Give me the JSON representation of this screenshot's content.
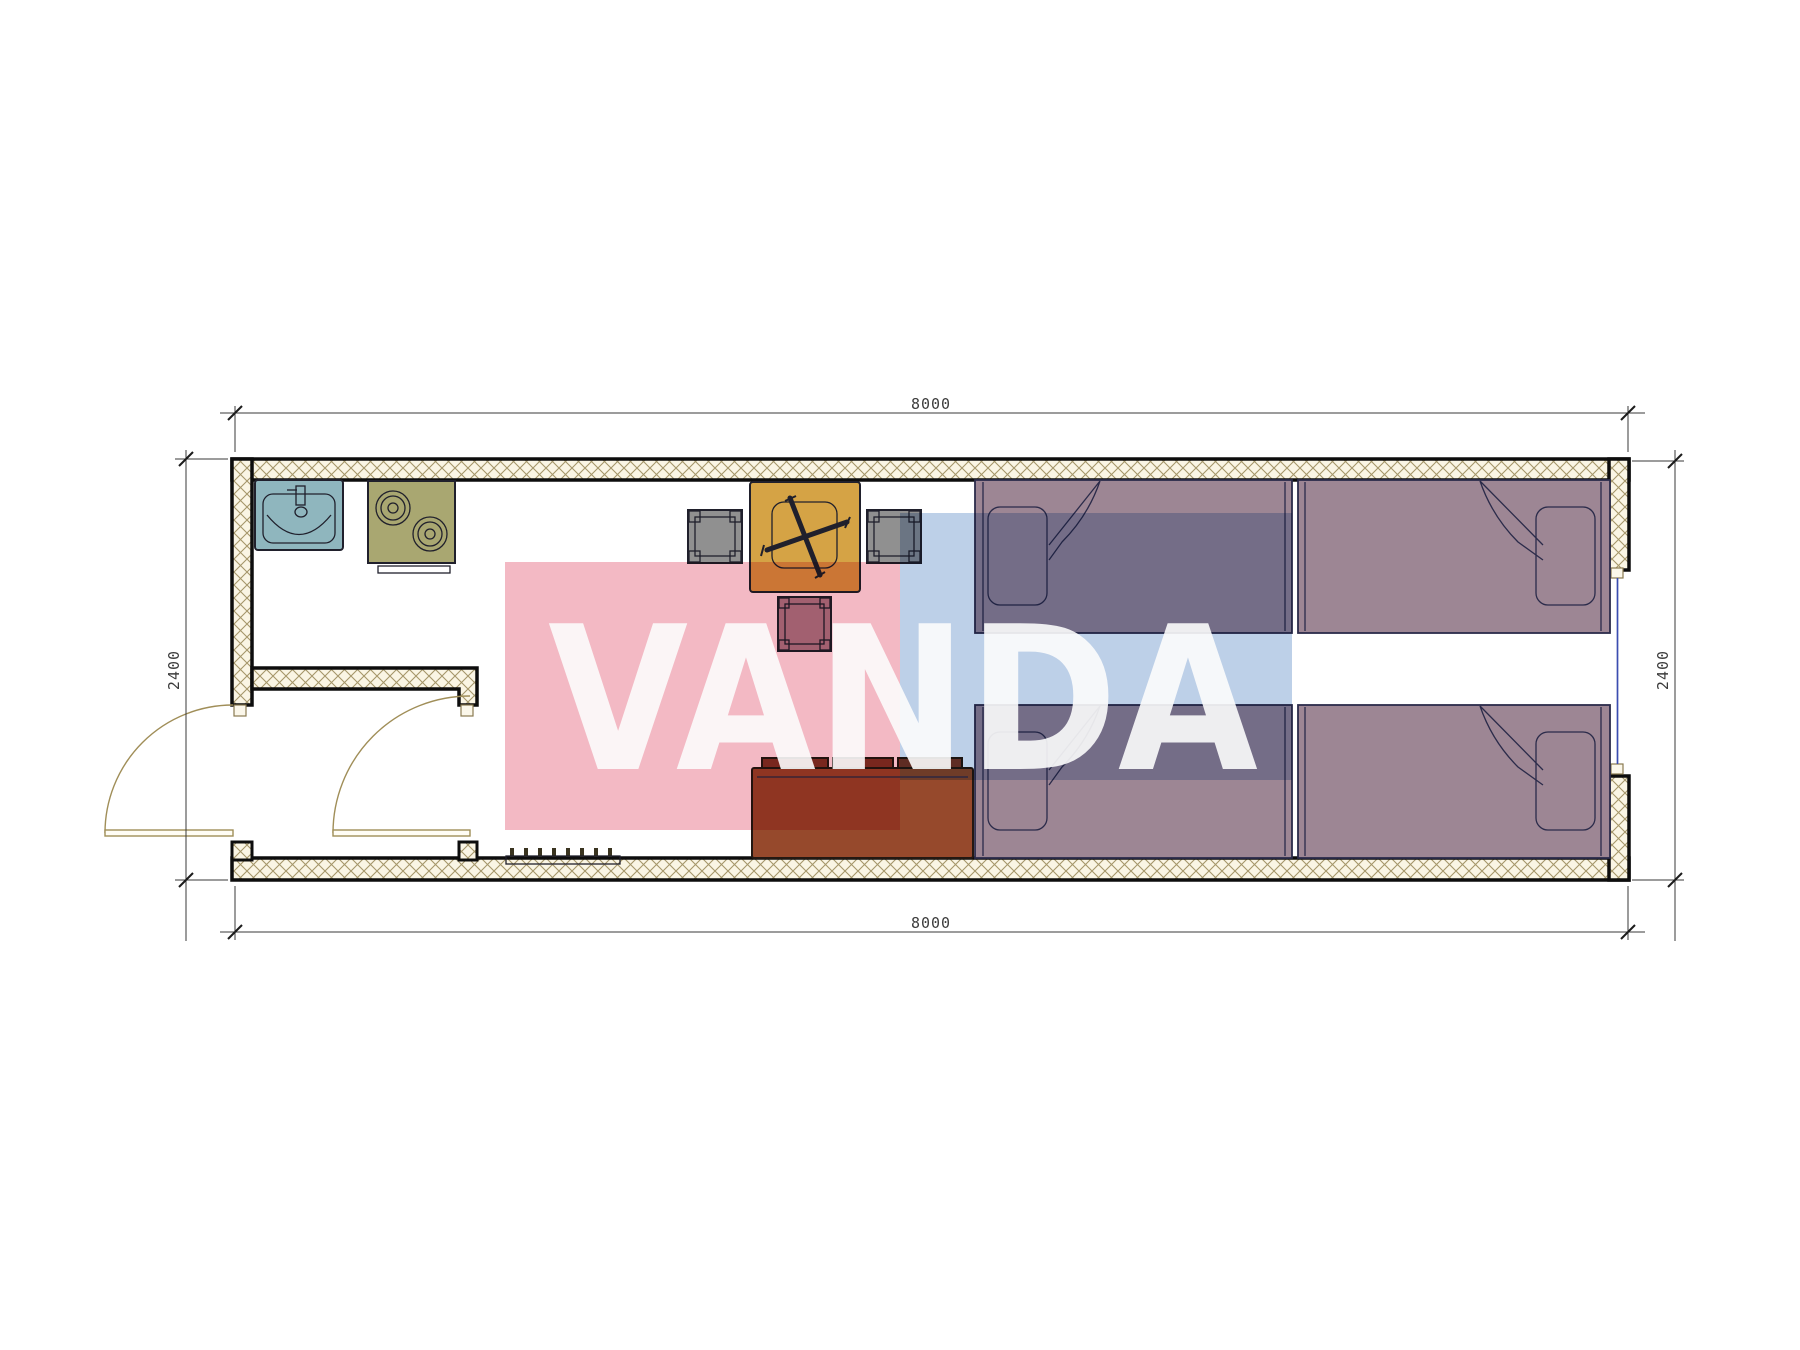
{
  "watermark": {
    "text": "VANDA",
    "pink_color": "#f3b9c4",
    "blue_color": "#bdd0e8",
    "letter_color": "#fcfcfc"
  },
  "dimensions": {
    "top": "8000",
    "bottom": "8000",
    "left": "2400",
    "right": "2400"
  },
  "palette": {
    "wall_hatch": "#a5966a",
    "wall_fill": "#faf5e4",
    "sink": "#8fb6be",
    "sink_faucet": "#d6e4e8",
    "stove": "#a9a771",
    "table": "#d5a345",
    "stool_gray": "#909090",
    "stool_red": "#aa8492",
    "sofa": "#96492c",
    "sofa_cushion": "#7e3526",
    "bed": "#9d8694",
    "rack_bar": "#857548",
    "rack_teeth": "#3a3420"
  }
}
